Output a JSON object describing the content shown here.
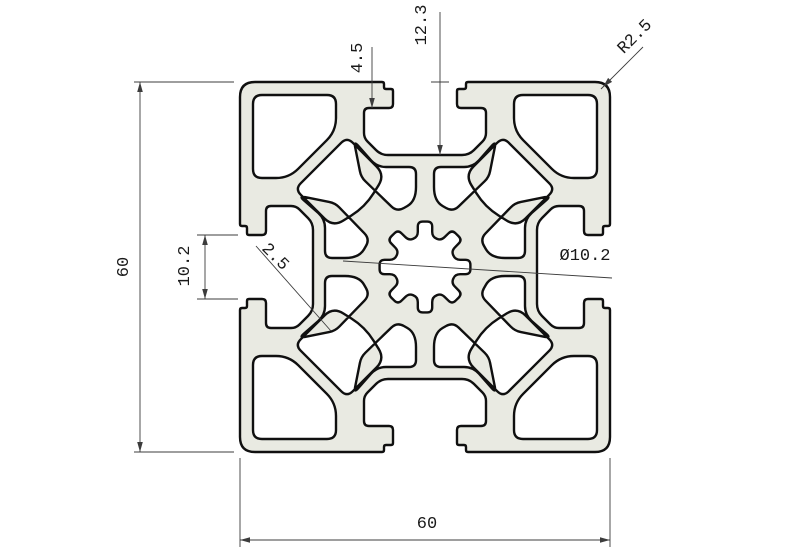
{
  "drawing": {
    "title": "aluminum-extrusion-profile-60x60",
    "labels": {
      "lip_depth": "4.5",
      "slot_depth": "12.3",
      "corner_radius": "R2.5",
      "height": "60",
      "width": "60",
      "slot_width": "10.2",
      "rib_thickness": "2.5",
      "bore_diameter": "Ø10.2"
    }
  },
  "geometry": {
    "center": [
      425,
      267
    ],
    "half": 185,
    "corner_radius": 15,
    "fill": "#e9eae2",
    "stroke": "#101010",
    "stroke_width": 2.4,
    "dim_color": "#3c3c3c",
    "dim_width": 0.9,
    "slot": [
      [
        -41,
        -185,
        2
      ],
      [
        -41,
        -178,
        2
      ],
      [
        -32,
        -178,
        2
      ],
      [
        -32,
        -159,
        4
      ],
      [
        -61,
        -159,
        5
      ],
      [
        -61,
        -129,
        5
      ],
      [
        -44,
        -112,
        7
      ],
      [
        44,
        -112,
        7
      ],
      [
        61,
        -129,
        5
      ],
      [
        61,
        -159,
        5
      ],
      [
        32,
        -159,
        4
      ],
      [
        32,
        -178,
        2
      ],
      [
        41,
        -178,
        2
      ],
      [
        41,
        -185,
        2
      ]
    ],
    "holes": [
      [
        [
          -172,
          -172,
          9
        ],
        [
          -89,
          -172,
          9
        ],
        [
          -89,
          -136,
          13
        ],
        [
          -136,
          -89,
          13
        ],
        [
          -172,
          -89,
          9
        ]
      ],
      [
        [
          -78,
          -130,
          8
        ],
        [
          -40,
          -92,
          12
        ],
        [
          -60,
          -60,
          16
        ],
        [
          -92,
          -40,
          12
        ],
        [
          -130,
          -78,
          8
        ]
      ],
      [
        [
          -71,
          -126,
          6
        ],
        [
          -48,
          -100,
          9
        ],
        [
          -9,
          -100,
          7
        ],
        [
          -9,
          -66,
          14
        ],
        [
          -28,
          -55,
          8
        ],
        [
          -64,
          -90,
          6
        ]
      ],
      [
        [
          -126,
          -71,
          6
        ],
        [
          -100,
          -48,
          9
        ],
        [
          -100,
          -9,
          7
        ],
        [
          -66,
          -9,
          14
        ],
        [
          -55,
          -28,
          8
        ],
        [
          -90,
          -64,
          6
        ]
      ]
    ],
    "gear": {
      "teeth": 8,
      "tip_r": 31,
      "groove_r": 46,
      "groove_half": 9,
      "tip_half": 9,
      "start": -90,
      "round": 5
    },
    "dim_lines": [
      [
        140,
        82,
        140,
        452
      ],
      [
        234,
        82,
        134,
        82
      ],
      [
        234,
        452,
        134,
        452
      ],
      [
        240,
        540,
        610,
        540
      ],
      [
        240,
        458,
        240,
        547
      ],
      [
        610,
        458,
        610,
        547
      ],
      [
        205,
        235,
        205,
        299
      ],
      [
        238,
        235,
        197,
        235
      ],
      [
        238,
        299,
        197,
        299
      ],
      [
        372,
        47,
        372,
        108
      ],
      [
        440,
        12,
        440,
        155
      ],
      [
        431,
        82,
        449,
        82
      ],
      [
        601,
        89,
        643,
        47
      ],
      [
        256,
        246,
        331,
        331
      ],
      [
        343,
        261,
        612,
        278
      ]
    ],
    "arrows": [
      [
        140,
        82,
        -90
      ],
      [
        140,
        452,
        90
      ],
      [
        240,
        540,
        180
      ],
      [
        610,
        540,
        0
      ],
      [
        205,
        235,
        -90
      ],
      [
        205,
        299,
        90
      ],
      [
        372,
        108,
        90
      ],
      [
        440,
        155,
        90
      ],
      [
        603,
        87,
        135
      ]
    ]
  }
}
